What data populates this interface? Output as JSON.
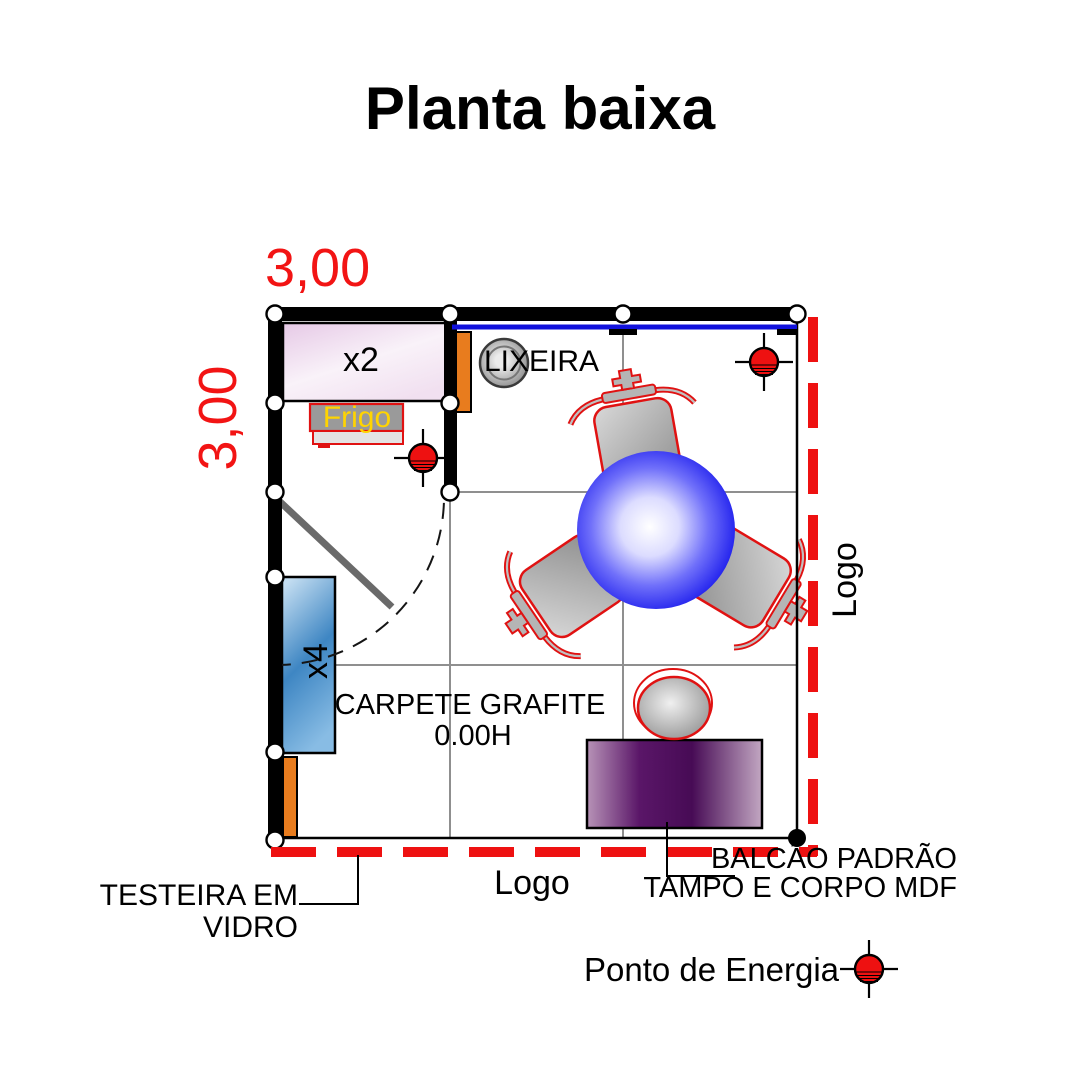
{
  "title": "Planta baixa",
  "dimensions": {
    "width": "3,00",
    "height": "3,00"
  },
  "booth": {
    "shelf_x2": "x2",
    "shelf_x4": "x4",
    "fridge": "Frigo",
    "trash_bin": "LIXEIRA",
    "carpet_line1": "CARPETE GRAFITE",
    "carpet_line2": "0.00H",
    "logo_right": "Logo",
    "logo_bottom": "Logo"
  },
  "callouts": {
    "testeira_line1": "TESTEIRA EM",
    "testeira_line2": "VIDRO",
    "balcao_line1": "BALCÃO PADRÃO",
    "balcao_line2": "TAMPO E CORPO MDF",
    "energy_legend": "Ponto de Energia"
  },
  "colors": {
    "dimension_red": "#f21414",
    "open_boundary_red": "#ee1111",
    "furniture_outline_red": "#e01212",
    "table_blue": "#1a1ae8",
    "glass_line_blue": "#1212dd",
    "panel_orange": "#e87c1e",
    "shelf_x4_blue": "#3e86c3",
    "shelf_x2_pink": "#e9cde9",
    "counter_purple": "#4a0d58",
    "frigo_text_yellow": "#ffd400",
    "wall_black": "#000000",
    "grid_gray": "#8f8f8f"
  }
}
